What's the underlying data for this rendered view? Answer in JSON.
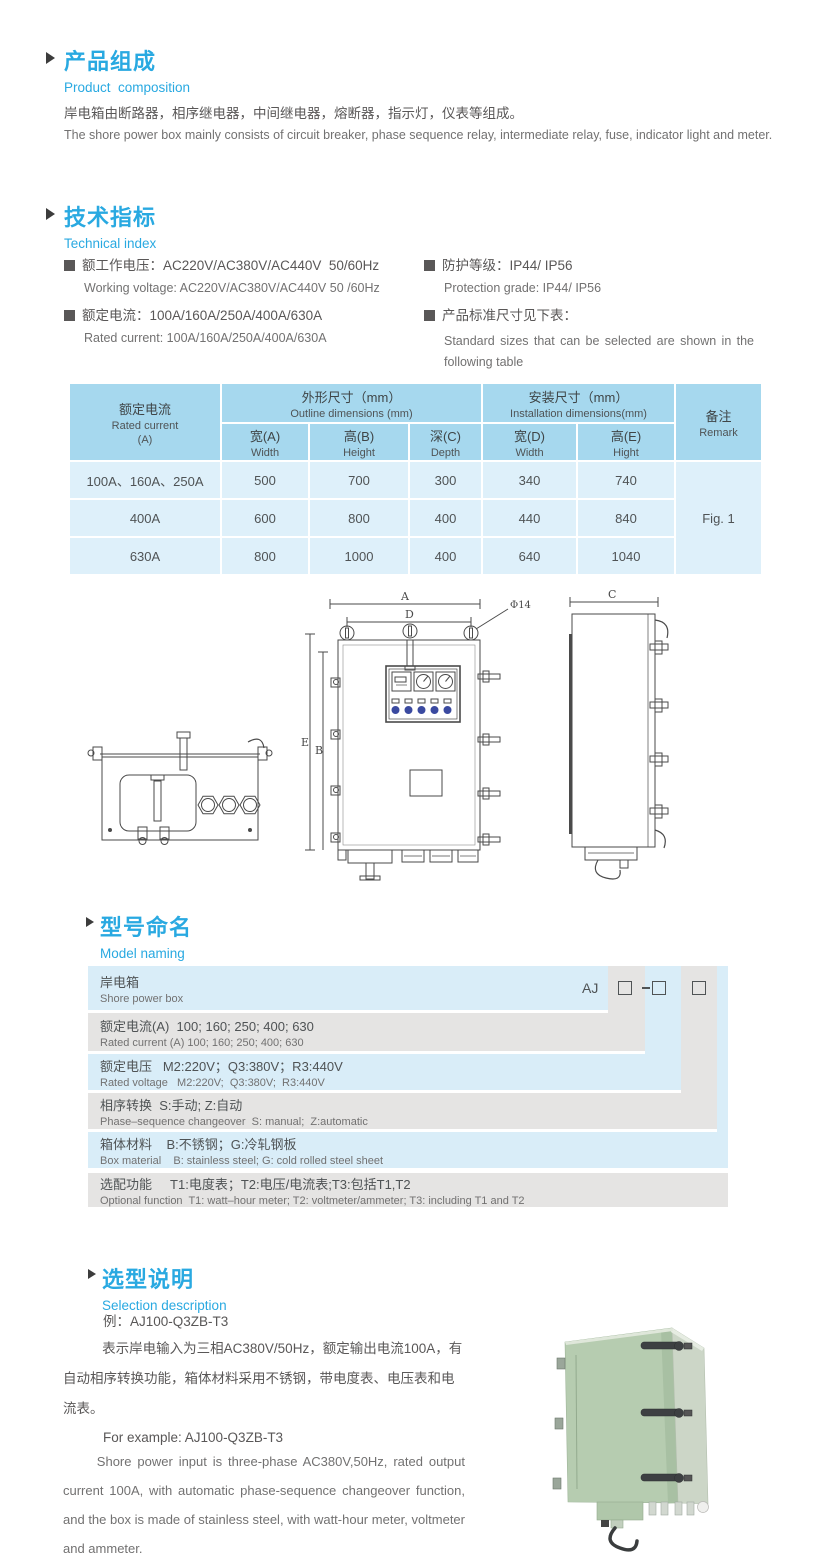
{
  "page": {
    "width": 830,
    "height": 1568,
    "background": "#ffffff"
  },
  "colors": {
    "accent_blue": "#29a9e1",
    "text_gray": "#595757",
    "table_header_bg": "#a6d8ee",
    "table_body_bg": "#def0fa",
    "ladder_blue": "#d9edf8",
    "ladder_gray": "#e5e4e3",
    "indicator_blue": "#3b4aa0",
    "photo_green": "#b6ccb0"
  },
  "icons": {
    "section_arrow": "triangle-right",
    "spec_bullet": "filled-square",
    "code_box": "empty-square"
  },
  "product_composition": {
    "title_zh": "产品组成",
    "title_en": "Product  composition",
    "body_zh": "岸电箱由断路器，相序继电器，中间继电器，熔断器，指示灯，仪表等组成。",
    "body_en": "The shore power box mainly consists of circuit breaker, phase sequence relay, intermediate relay, fuse, indicator light and meter."
  },
  "technical_index": {
    "title_zh": "技术指标",
    "title_en": "Technical index",
    "specs_left": [
      {
        "zh": "额工作电压：AC220V/AC380V/AC440V  50/60Hz",
        "en": "Working voltage: AC220V/AC380V/AC440V 50 /60Hz"
      },
      {
        "zh": "额定电流：100A/160A/250A/400A/630A",
        "en": "Rated current: 100A/160A/250A/400A/630A"
      }
    ],
    "specs_right": [
      {
        "zh": "防护等级：IP44/ IP56",
        "en": "Protection grade: IP44/ IP56"
      },
      {
        "zh": "产品标准尺寸见下表：",
        "en": "Standard sizes that can be selected are shown in the following table"
      }
    ]
  },
  "table": {
    "header": {
      "rated_current_zh": "额定电流",
      "rated_current_en": "Rated current",
      "rated_current_unit": "(A)",
      "outline_zh": "外形尺寸（mm）",
      "outline_en": "Outline dimensions (mm)",
      "installation_zh": "安装尺寸（mm）",
      "installation_en": "Installation dimensions(mm)",
      "remark_zh": "备注",
      "remark_en": "Remark",
      "sub": [
        {
          "zh": "宽(A)",
          "en": "Width"
        },
        {
          "zh": "高(B)",
          "en": "Height"
        },
        {
          "zh": "深(C)",
          "en": "Depth"
        },
        {
          "zh": "宽(D)",
          "en": "Width"
        },
        {
          "zh": "高(E)",
          "en": "Hight"
        }
      ]
    },
    "rows": [
      {
        "current": "100A、160A、250A",
        "values": [
          "500",
          "700",
          "300",
          "340",
          "740"
        ]
      },
      {
        "current": "400A",
        "values": [
          "600",
          "800",
          "400",
          "440",
          "840"
        ]
      },
      {
        "current": "630A",
        "values": [
          "800",
          "1000",
          "400",
          "640",
          "1040"
        ]
      }
    ],
    "remark_value": "Fig. 1"
  },
  "drawing": {
    "labels": {
      "dim_a": "A",
      "dim_d": "D",
      "hole": "Φ14",
      "dim_e": "E",
      "dim_b": "B",
      "dim_c": "C"
    }
  },
  "model_naming": {
    "title_zh": "型号命名",
    "title_en": "Model naming",
    "prefix": "AJ",
    "rows": [
      {
        "zh": "岸电箱",
        "en": "Shore power box"
      },
      {
        "zh": "额定电流(A)  100; 160; 250; 400; 630",
        "en": "Rated current (A) 100; 160; 250; 400; 630"
      },
      {
        "zh": "额定电压   M2:220V；Q3:380V；R3:440V",
        "en": "Rated voltage   M2:220V;  Q3:380V;  R3:440V"
      },
      {
        "zh": "相序转换  S:手动; Z:自动",
        "en": "Phase–sequence changeover  S: manual;  Z:automatic"
      },
      {
        "zh": "箱体材料    B:不锈钢；G:冷轧钢板",
        "en": "Box material    B: stainless steel; G: cold rolled steel sheet"
      },
      {
        "zh": "选配功能     T1:电度表；T2:电压/电流表;T3:包括T1,T2",
        "en": "Optional function  T1: watt–hour meter; T2: voltmeter/ammeter; T3: including T1 and T2"
      }
    ]
  },
  "selection": {
    "title_zh": "选型说明",
    "title_en": "Selection description",
    "example_zh": "例：AJ100-Q3ZB-T3",
    "body_zh": "表示岸电输入为三相AC380V/50Hz，额定输出电流100A，有自动相序转换功能，箱体材料采用不锈钢，带电度表、电压表和电流表。",
    "example_en": "For example: AJ100-Q3ZB-T3",
    "body_en": "Shore power input is three-phase AC380V,50Hz, rated output current 100A, with automatic phase-sequence changeover function, and the box is made of stainless steel, with watt-hour meter, voltmeter and ammeter."
  }
}
